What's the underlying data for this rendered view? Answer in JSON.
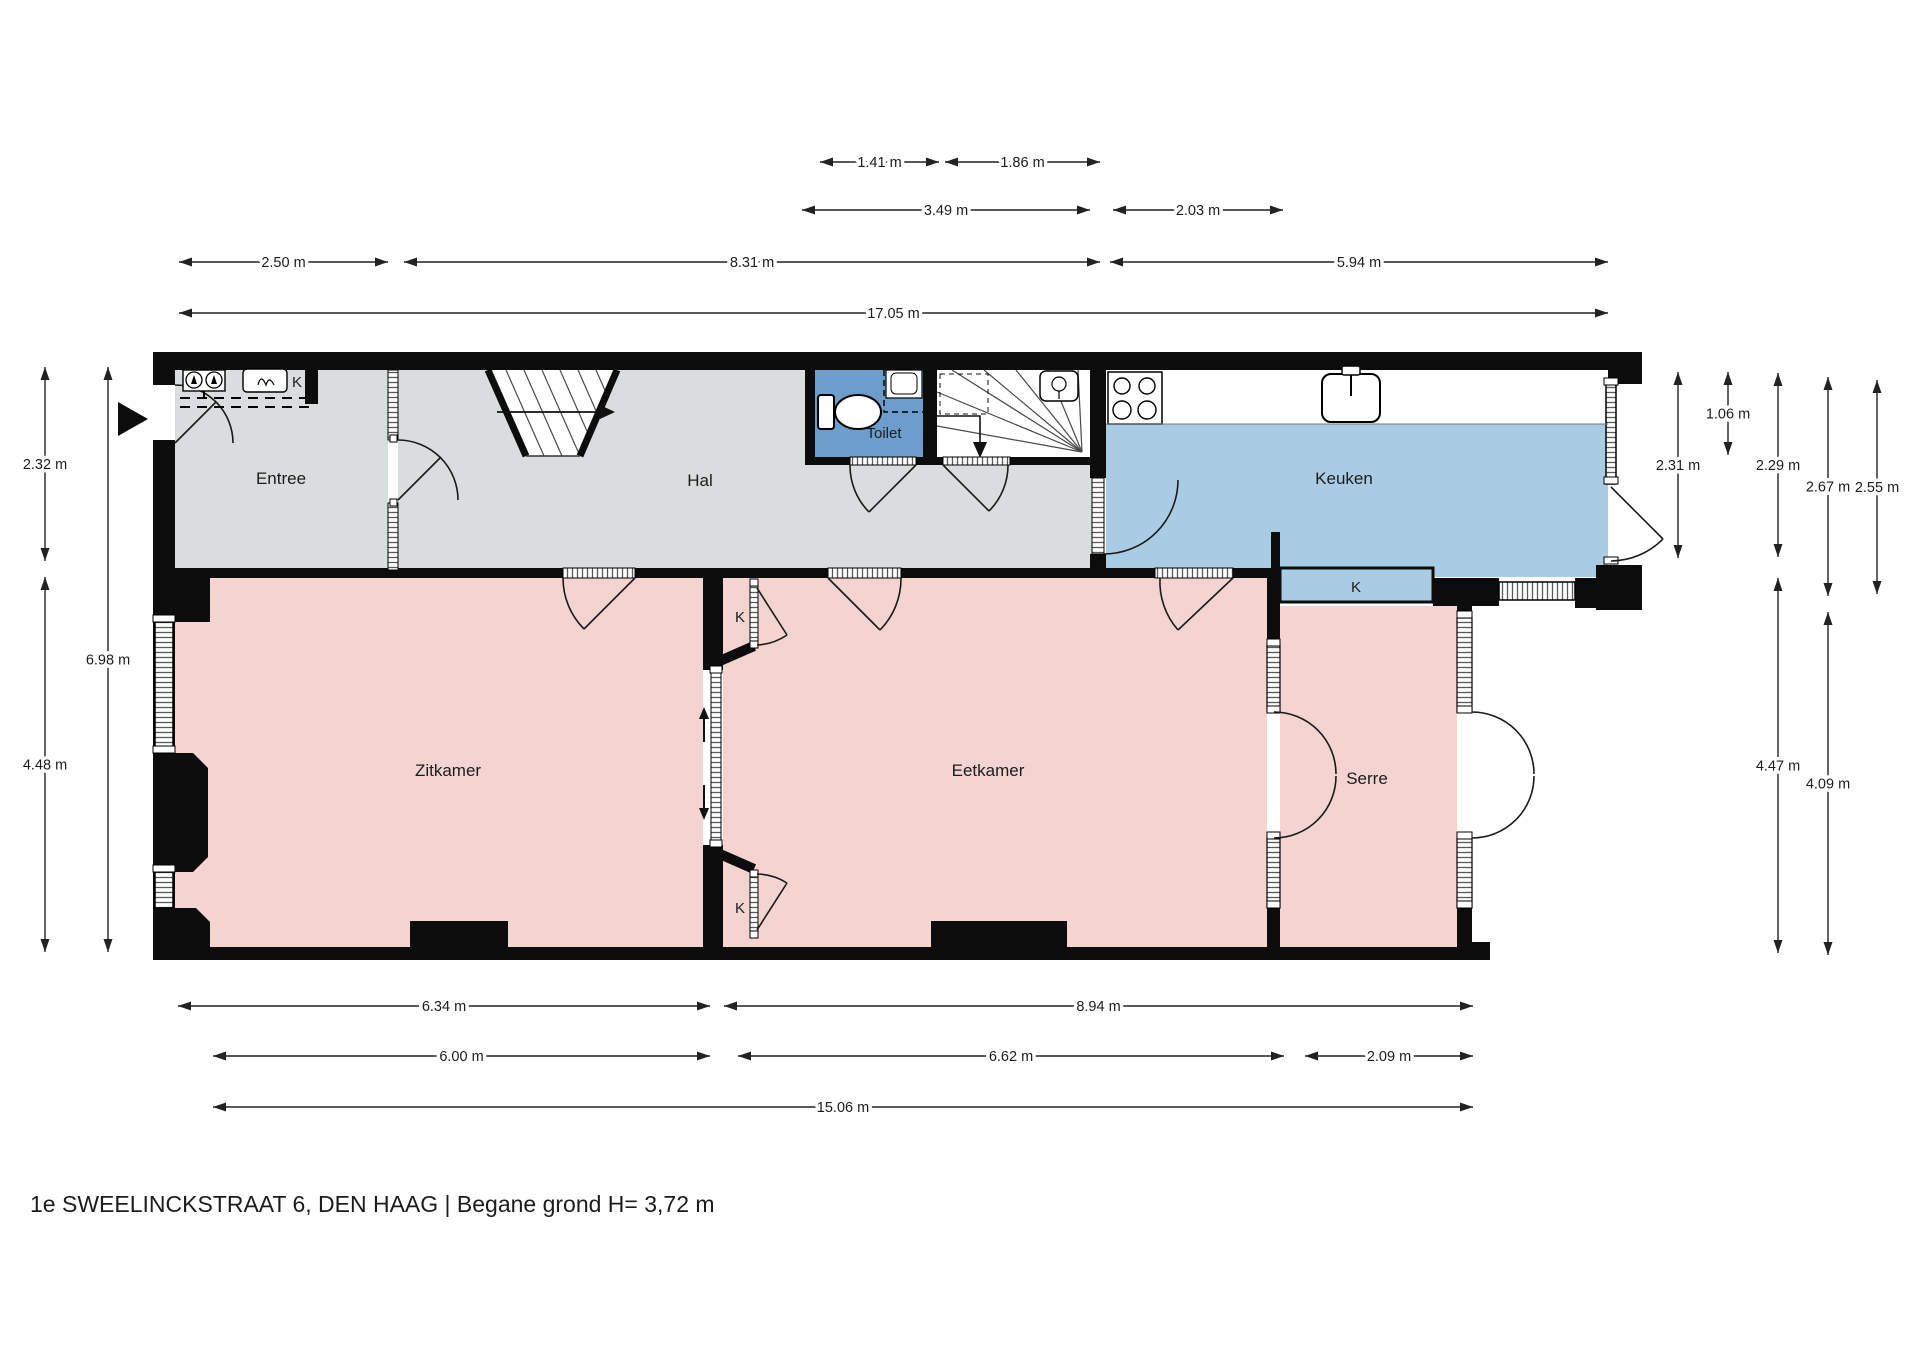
{
  "title": "1e SWEELINCKSTRAAT 6, DEN HAAG | Begane grond H= 3,72 m",
  "rooms": {
    "entree": {
      "label": "Entree"
    },
    "hal": {
      "label": "Hal"
    },
    "toilet": {
      "label": "Toilet"
    },
    "keuken": {
      "label": "Keuken"
    },
    "zitkamer": {
      "label": "Zitkamer"
    },
    "eetkamer": {
      "label": "Eetkamer"
    },
    "serre": {
      "label": "Serre"
    }
  },
  "closet_label": "K",
  "colors": {
    "room_pink": "#f3d4d1",
    "room_grey": "#d9dddd",
    "keuken_blue": "#a9cce5",
    "toilet_blue": "#6d9dcb",
    "wall_black": "#0c0c0c"
  },
  "dimensions": {
    "horizontal": [
      {
        "label": "1.41 m",
        "x1": 820,
        "x2": 939,
        "y": 162
      },
      {
        "label": "1.86 m",
        "x1": 945,
        "x2": 1100,
        "y": 162
      },
      {
        "label": "3.49 m",
        "x1": 802,
        "x2": 1090,
        "y": 210
      },
      {
        "label": "2.03 m",
        "x1": 1113,
        "x2": 1283,
        "y": 210
      },
      {
        "label": "2.50 m",
        "x1": 179,
        "x2": 388,
        "y": 262
      },
      {
        "label": "8.31 m",
        "x1": 404,
        "x2": 1100,
        "y": 262
      },
      {
        "label": "5.94 m",
        "x1": 1110,
        "x2": 1608,
        "y": 262
      },
      {
        "label": "17.05 m",
        "x1": 179,
        "x2": 1608,
        "y": 313
      },
      {
        "label": "6.34 m",
        "x1": 178,
        "x2": 710,
        "y": 1006
      },
      {
        "label": "8.94 m",
        "x1": 724,
        "x2": 1473,
        "y": 1006
      },
      {
        "label": "6.00 m",
        "x1": 213,
        "x2": 710,
        "y": 1056
      },
      {
        "label": "6.62 m",
        "x1": 738,
        "x2": 1284,
        "y": 1056
      },
      {
        "label": "2.09 m",
        "x1": 1305,
        "x2": 1473,
        "y": 1056
      },
      {
        "label": "15.06 m",
        "x1": 213,
        "x2": 1473,
        "y": 1107
      }
    ],
    "vertical": [
      {
        "label": "2.32 m",
        "y1": 367,
        "y2": 561,
        "x": 45
      },
      {
        "label": "4.48 m",
        "y1": 577,
        "y2": 952,
        "x": 45
      },
      {
        "label": "6.98 m",
        "y1": 367,
        "y2": 952,
        "x": 108
      },
      {
        "label": "2.31 m",
        "y1": 372,
        "y2": 558,
        "x": 1678
      },
      {
        "label": "1.06 m",
        "y1": 372,
        "y2": 455,
        "x": 1728
      },
      {
        "label": "2.29 m",
        "y1": 373,
        "y2": 557,
        "x": 1778
      },
      {
        "label": "4.47 m",
        "y1": 578,
        "y2": 953,
        "x": 1778
      },
      {
        "label": "2.67 m",
        "y1": 377,
        "y2": 596,
        "x": 1828
      },
      {
        "label": "4.09 m",
        "y1": 612,
        "y2": 955,
        "x": 1828
      },
      {
        "label": "2.55 m",
        "y1": 380,
        "y2": 594,
        "x": 1877
      }
    ]
  }
}
